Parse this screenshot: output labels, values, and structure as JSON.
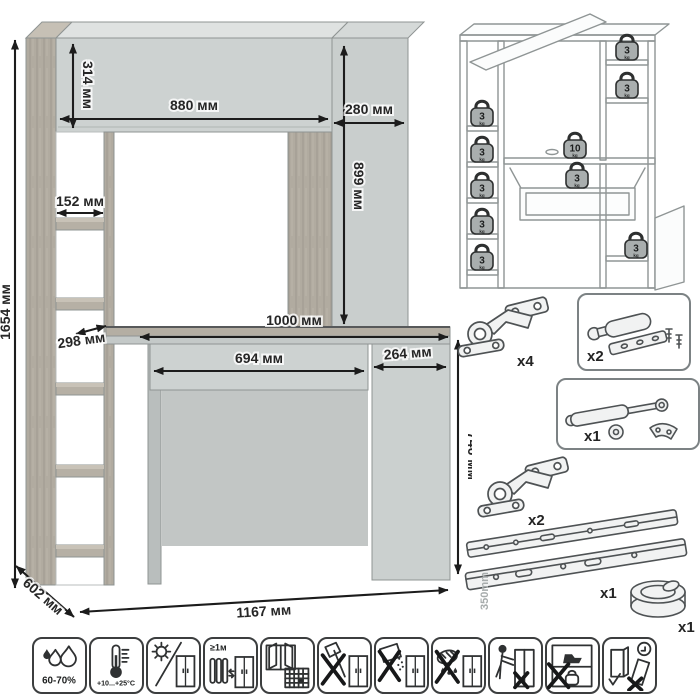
{
  "dimensions": {
    "total_height": "1654 мм",
    "top_section_height": "314 мм",
    "top_left_width": "880 мм",
    "top_right_width": "280 мм",
    "right_cabinet_height": "899 мм",
    "shelf_width": "152 мм",
    "shelf_depth": "298 мм",
    "desktop_width": "1000 мм",
    "drawer_width": "694 мм",
    "door_width": "264 мм",
    "desk_height": "746 мм",
    "depth": "602 мм",
    "total_width": "1167 мм"
  },
  "load_diagram": {
    "weights": [
      {
        "value": "3",
        "unit": "kg",
        "location": "left-shelf-1"
      },
      {
        "value": "3",
        "unit": "kg",
        "location": "left-shelf-2"
      },
      {
        "value": "3",
        "unit": "kg",
        "location": "left-shelf-3"
      },
      {
        "value": "3",
        "unit": "kg",
        "location": "left-shelf-4"
      },
      {
        "value": "3",
        "unit": "kg",
        "location": "left-shelf-5"
      },
      {
        "value": "3",
        "unit": "kg",
        "location": "right-top-shelf"
      },
      {
        "value": "3",
        "unit": "kg",
        "location": "right-mid-shelf"
      },
      {
        "value": "10",
        "unit": "kg",
        "location": "desktop"
      },
      {
        "value": "3",
        "unit": "kg",
        "location": "drawer"
      },
      {
        "value": "3",
        "unit": "kg",
        "location": "base-cabinet"
      }
    ]
  },
  "hardware": {
    "items": [
      {
        "id": "hinge-top",
        "qty": "x4"
      },
      {
        "id": "door-damper",
        "qty": "x2"
      },
      {
        "id": "gas-lift",
        "qty": "x1"
      },
      {
        "id": "hinge-bottom",
        "qty": "x2"
      },
      {
        "id": "drawer-slides",
        "qty": "x1",
        "length_label": "350mm"
      },
      {
        "id": "cable-grommet",
        "qty": "x1"
      }
    ]
  },
  "care_icons": [
    {
      "id": "humidity",
      "label": "60-70%"
    },
    {
      "id": "temperature",
      "label": "+10...+25°C"
    },
    {
      "id": "no-direct-sunlight",
      "label": ""
    },
    {
      "id": "heat-distance",
      "label": "≥1м"
    },
    {
      "id": "ventilation",
      "label": "21"
    },
    {
      "id": "no-impact",
      "label": ""
    },
    {
      "id": "no-abrasives",
      "label": ""
    },
    {
      "id": "no-wet-cleaning",
      "label": ""
    },
    {
      "id": "no-dragging",
      "label": ""
    },
    {
      "id": "no-overload",
      "label": ""
    },
    {
      "id": "carry-upright",
      "label": ""
    }
  ],
  "colors": {
    "facade": "#cdd2d1",
    "facade_top": "#dfe2e1",
    "wood": "#b1aba0",
    "arrow": "#1c1c1c",
    "outline": "#8f9595"
  }
}
